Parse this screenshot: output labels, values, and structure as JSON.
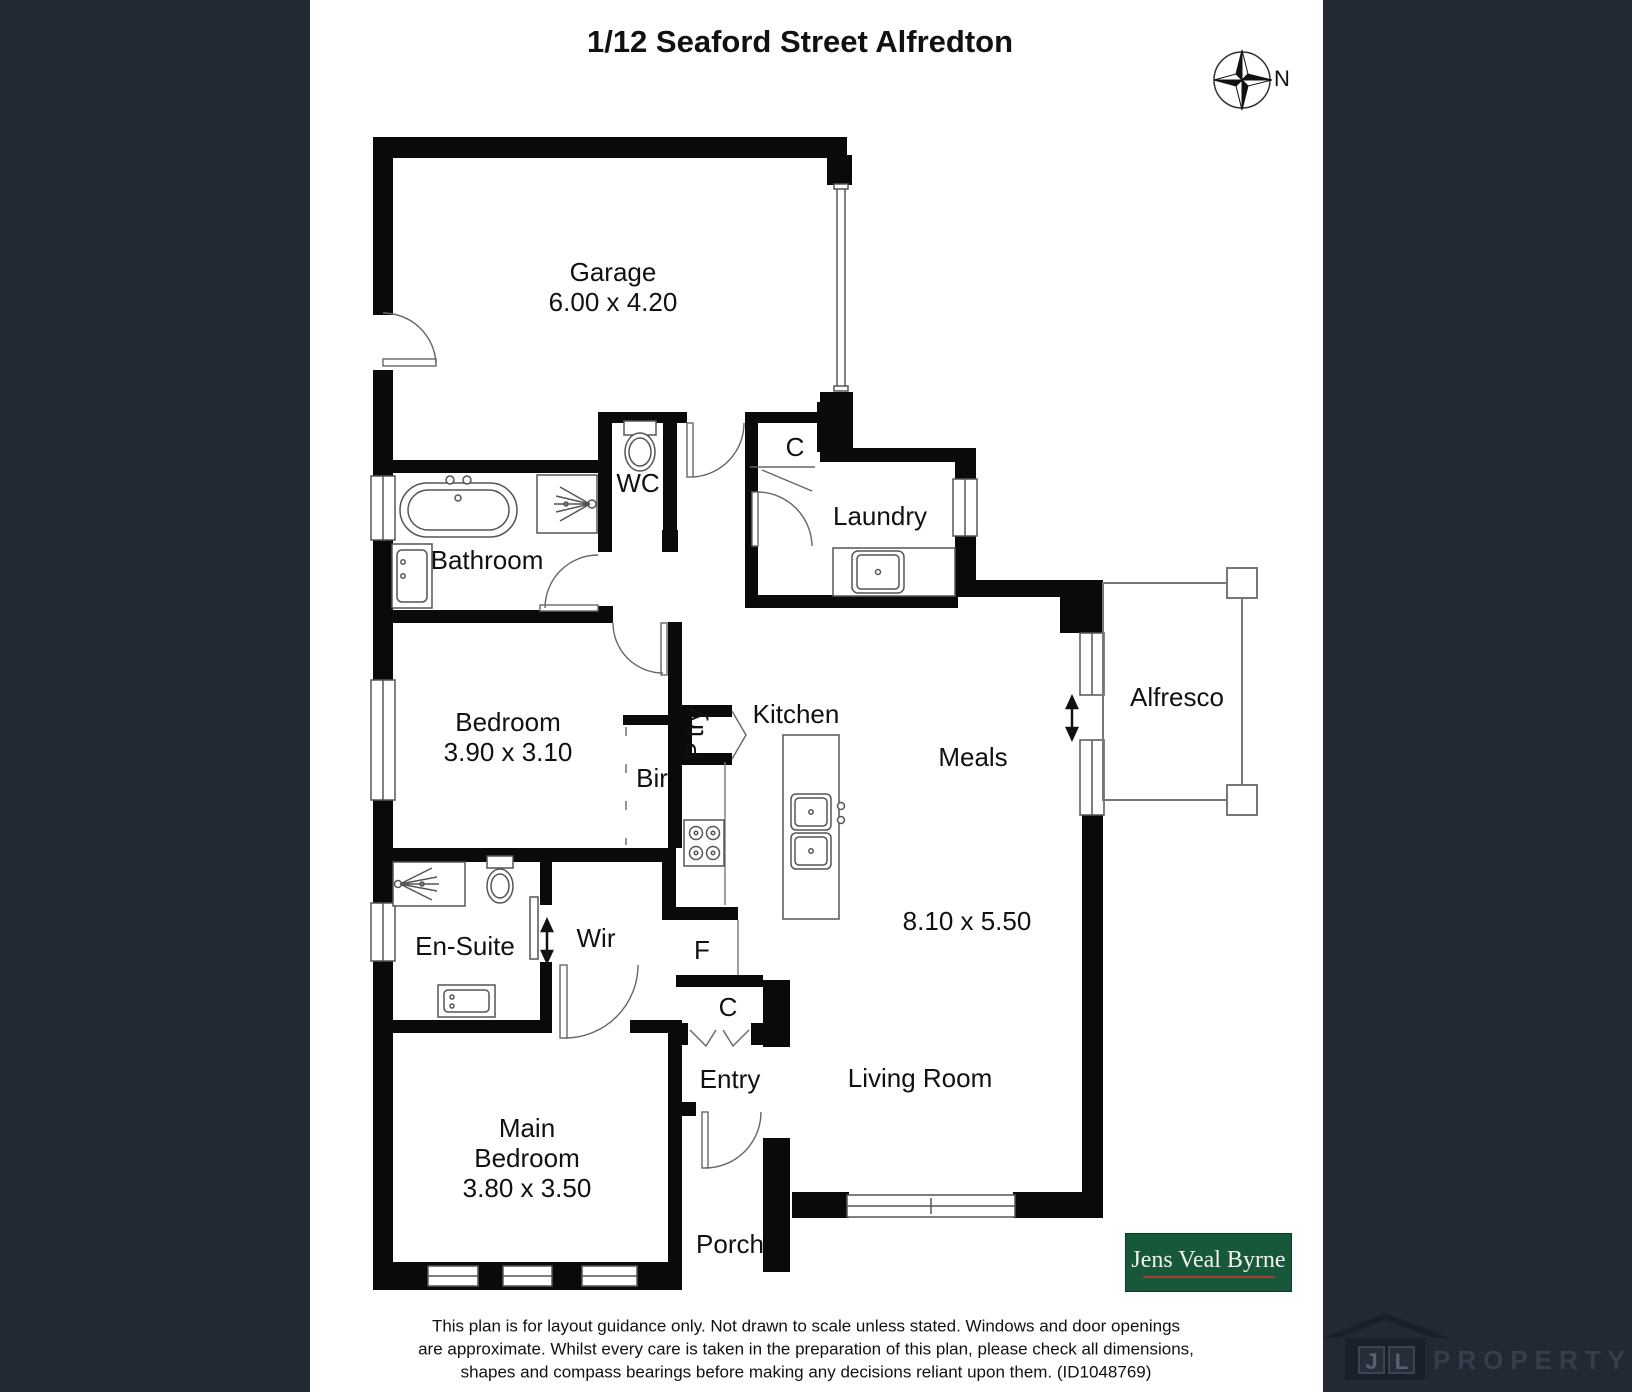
{
  "header": {
    "title": "1/12 Seaford Street Alfredton",
    "compass_label": "N"
  },
  "rooms": {
    "garage": {
      "name": "Garage",
      "dim": "6.00 x 4.20"
    },
    "wc": {
      "name": "WC"
    },
    "closet_hall": {
      "name": "C"
    },
    "laundry": {
      "name": "Laundry"
    },
    "bathroom": {
      "name": "Bathroom"
    },
    "bedroom": {
      "name": "Bedroom",
      "dim": "3.90 x 3.10"
    },
    "bir": {
      "name": "Bir"
    },
    "pantry": {
      "name": "P'try"
    },
    "kitchen": {
      "name": "Kitchen"
    },
    "meals": {
      "name": "Meals"
    },
    "alfresco": {
      "name": "Alfresco"
    },
    "ensuite": {
      "name": "En-Suite"
    },
    "wir": {
      "name": "Wir"
    },
    "fridge": {
      "name": "F"
    },
    "closet_entry": {
      "name": "C"
    },
    "entry": {
      "name": "Entry"
    },
    "living": {
      "name": "Living Room",
      "dim": "8.10 x 5.50"
    },
    "main_bedroom": {
      "line1": "Main",
      "line2": "Bedroom",
      "dim": "3.80 x 3.50"
    },
    "porch": {
      "name": "Porch"
    }
  },
  "footer": {
    "disclaimer_line1": "This plan is for layout guidance only. Not drawn to scale unless stated. Windows and door openings",
    "disclaimer_line2": "are approximate. Whilst every care is taken in the preparation of this plan, please check all dimensions,",
    "disclaimer_line3": "shapes and compass bearings before making any decisions reliant upon them. (ID1048769)"
  },
  "branding": {
    "agency_name": "Jens Veal Byrne",
    "watermark_monogram_j": "J",
    "watermark_monogram_l": "L",
    "watermark_text": "PROPERTY"
  },
  "colors": {
    "panel_background": "#232933",
    "wall": "#0a0a0a",
    "agency_green": "#17573a",
    "agency_underline": "#a83c31"
  }
}
